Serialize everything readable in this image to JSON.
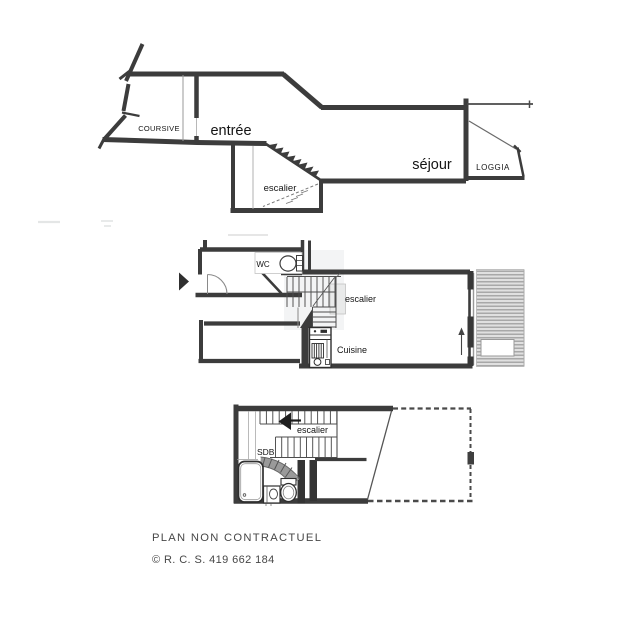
{
  "plans": {
    "upper": {
      "labels": {
        "coursive": "COURSIVE",
        "entree": "entrée",
        "escalier": "escalier",
        "sejour": "séjour",
        "loggia": "LOGGIA"
      }
    },
    "middle": {
      "labels": {
        "wc": "WC",
        "escalier": "escalier",
        "cuisine": "Cuisine"
      }
    },
    "lower": {
      "labels": {
        "escalier": "escalier",
        "sdb": "SDB"
      }
    }
  },
  "footer": {
    "line1": "PLAN NON CONTRACTUEL",
    "line2": "© R. C. S. 419 662 184"
  },
  "colors": {
    "wall": "#3c3c3c",
    "thin_line": "#9a9a9a",
    "balcony_base": "#e0e0e0",
    "balcony_stripe": "#a8a8a8",
    "label_text": "#141414",
    "footer_text": "#474747",
    "background": "#ffffff"
  }
}
